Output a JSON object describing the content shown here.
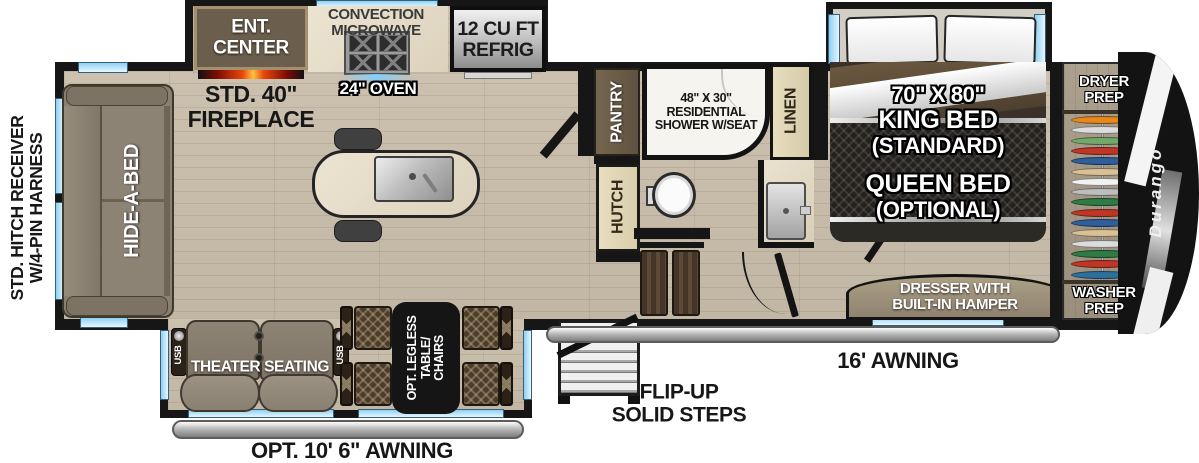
{
  "hitch": {
    "label": "STD. HITCH RECEIVER\nW/4-PIN HARNESS"
  },
  "living": {
    "sofa_label": "HIDE-A-BED",
    "ent_center_label": "ENT.\nCENTER",
    "fireplace_label": "STD. 40\"\nFIREPLACE",
    "theater_label": "THEATER SEATING",
    "usb_label": "USB",
    "table_label": "OPT. LEGLESS\nTABLE/\nCHAIRS",
    "awning_rear_label": "OPT. 10' 6\" AWNING"
  },
  "kitchen": {
    "microwave_label": "CONVECTION\nMICROWAVE",
    "oven_label": "24\" OVEN",
    "fridge_label": "12 CU FT\nREFRIG",
    "pantry_label": "PANTRY",
    "hutch_label": "HUTCH"
  },
  "bath": {
    "shower_label": "48\" X 30\"\nRESIDENTIAL\nSHOWER W/SEAT",
    "linen_label": "LINEN"
  },
  "bedroom": {
    "bed_size_label": "70\" X 80\"",
    "bed_king_label": "KING BED",
    "bed_king_note": "(STANDARD)",
    "bed_queen_label": "QUEEN BED",
    "bed_queen_note": "(OPTIONAL)",
    "dresser_label": "DRESSER WITH\nBUILT-IN HAMPER",
    "dryer_label": "DRYER\nPREP",
    "washer_label": "WASHER\nPREP",
    "hanger_colors": [
      "#e5891f",
      "#dcdcdc",
      "#74a86a",
      "#bf3527",
      "#2f5e9c",
      "#d9c197",
      "#f2f2f2",
      "#bdbdbd",
      "#2f7a45",
      "#bf3527",
      "#2f5e9c",
      "#d9c197",
      "#dcdcdc",
      "#2f7a45",
      "#bf3527",
      "#2e6f9c"
    ]
  },
  "exterior": {
    "steps_label": "FLIP-UP\nSOLID STEPS",
    "awning_main_label": "16' AWNING",
    "brand_logo": "Durango"
  },
  "colors": {
    "wall": "#161616",
    "window_blue": "#8fd0f2",
    "floor_wood": "#c7bba9",
    "fireplace_glow": "#e8470b",
    "awning_silver": "#b9b9b9"
  }
}
